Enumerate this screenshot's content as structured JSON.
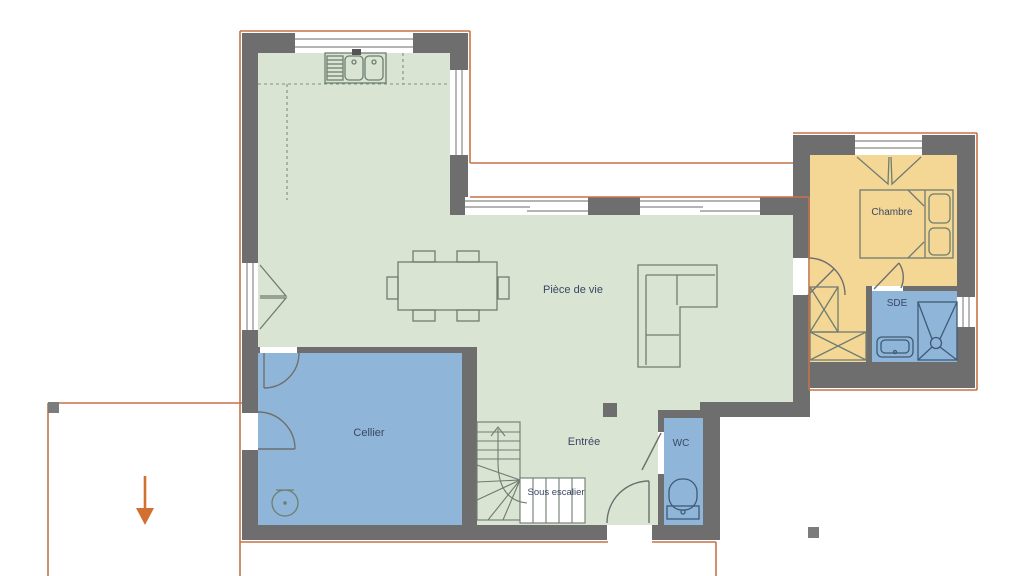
{
  "palette": {
    "background": "#ffffff",
    "wall": "#6e6e6e",
    "living_floor": "#d9e5d2",
    "wet_room_floor": "#8fb6d9",
    "bedroom_floor": "#f4d794",
    "plot_outline": "#c4744a",
    "arrow": "#d2702f",
    "label_text": "#3b4663"
  },
  "rooms": {
    "living": {
      "label": "Pièce de vie",
      "color": "#d9e5d2"
    },
    "bedroom": {
      "label": "Chambre",
      "color": "#f4d794"
    },
    "shower_room": {
      "label": "SDE",
      "color": "#8fb6d9"
    },
    "pantry": {
      "label": "Cellier",
      "color": "#8fb6d9"
    },
    "entrance": {
      "label": "Entrée",
      "color": "#d9e5d2"
    },
    "wc": {
      "label": "WC",
      "color": "#8fb6d9"
    },
    "under_stairs": {
      "label": "Sous escalier",
      "color": "#ffffff"
    }
  }
}
